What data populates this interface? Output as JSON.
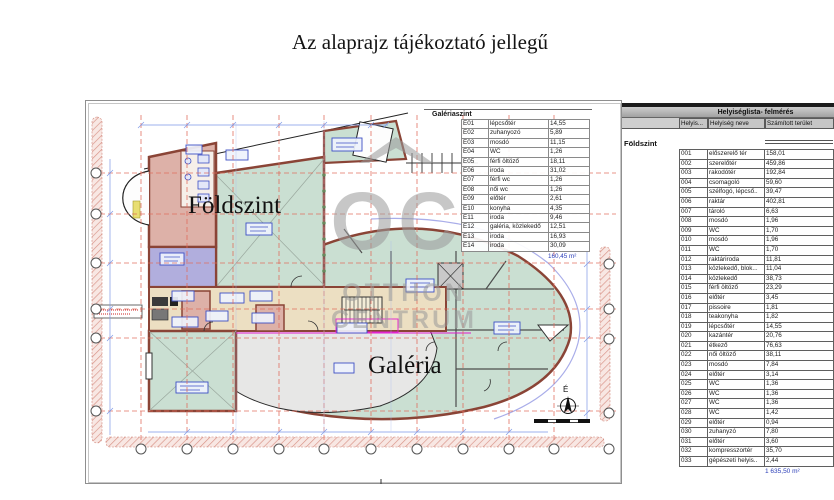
{
  "title": "Az alaprajz tájékoztató jellegű",
  "plan": {
    "floor_label": "Földszint",
    "gallery_label": "Galéria",
    "north_label": "É",
    "watermark": {
      "logo": "OC",
      "line1": "OTTHON",
      "line2": "CENTRUM"
    },
    "galeriaszint_table": {
      "title": "Galériaszint",
      "rows": [
        [
          "E01",
          "lépcsőtér",
          "14,55"
        ],
        [
          "E02",
          "zuhanyozó",
          "5,89"
        ],
        [
          "E03",
          "mosdó",
          "11,15"
        ],
        [
          "E04",
          "WC",
          "1,26"
        ],
        [
          "E05",
          "férfi öltöző",
          "18,11"
        ],
        [
          "E06",
          "iroda",
          "31,02"
        ],
        [
          "E07",
          "férfi wc",
          "1,26"
        ],
        [
          "E08",
          "női wc",
          "1,26"
        ],
        [
          "E09",
          "előtér",
          "2,61"
        ],
        [
          "E10",
          "konyha",
          "4,35"
        ],
        [
          "E11",
          "iroda",
          "9,46"
        ],
        [
          "E12",
          "galéria, közlekedő",
          "12,51"
        ],
        [
          "E13",
          "iroda",
          "16,93"
        ],
        [
          "E14",
          "iroda",
          "30,09"
        ]
      ],
      "total": "160,45 m²"
    }
  },
  "room_list": {
    "title": "Helyiséglista- felmérés",
    "columns": [
      "Helyis...",
      "Helyiség neve",
      "Számított terület"
    ],
    "section": "Földszint",
    "rows": [
      [
        "001",
        "előszerelő tér",
        "158,01"
      ],
      [
        "002",
        "szerelőtér",
        "459,86"
      ],
      [
        "003",
        "rakodótér",
        "192,84"
      ],
      [
        "004",
        "csomagoló",
        "59,60"
      ],
      [
        "005",
        "szélfogó, lépcső..",
        "39,47"
      ],
      [
        "006",
        "raktár",
        "402,81"
      ],
      [
        "007",
        "tároló",
        "6,63"
      ],
      [
        "008",
        "mosdó",
        "1,96"
      ],
      [
        "009",
        "WC",
        "1,70"
      ],
      [
        "010",
        "mosdó",
        "1,96"
      ],
      [
        "011",
        "WC",
        "1,70"
      ],
      [
        "012",
        "raktáriroda",
        "11,81"
      ],
      [
        "013",
        "közlekedő, blok...",
        "11,04"
      ],
      [
        "014",
        "közlekedő",
        "38,73"
      ],
      [
        "015",
        "férfi öltöző",
        "23,29"
      ],
      [
        "016",
        "előtér",
        "3,45"
      ],
      [
        "017",
        "pissoire",
        "1,81"
      ],
      [
        "018",
        "teakonyha",
        "1,82"
      ],
      [
        "019",
        "lépcsőtér",
        "14,55"
      ],
      [
        "020",
        "kazántér",
        "20,76"
      ],
      [
        "021",
        "étkező",
        "76,63"
      ],
      [
        "022",
        "női öltöző",
        "38,11"
      ],
      [
        "023",
        "mosdó",
        "7,84"
      ],
      [
        "024",
        "előtér",
        "3,14"
      ],
      [
        "025",
        "WC",
        "1,36"
      ],
      [
        "026",
        "WC",
        "1,36"
      ],
      [
        "027",
        "WC",
        "1,36"
      ],
      [
        "028",
        "WC",
        "1,42"
      ],
      [
        "029",
        "előtér",
        "0,94"
      ],
      [
        "030",
        "zuhanyzó",
        "7,80"
      ],
      [
        "031",
        "előtér",
        "3,60"
      ],
      [
        "032",
        "kompresszortér",
        "35,70"
      ],
      [
        "033",
        "gépészeti helyis..",
        "2,44"
      ]
    ],
    "total": "1 635,50 m²"
  },
  "colors": {
    "wall": "#8a4436",
    "room_green": "#cadfd2",
    "room_pink": "#ddb1a8",
    "room_purple": "#b1aedd",
    "room_tan": "#ecdfc2",
    "gallery_gray": "#e7e7e6",
    "grid_red": "#e0695a",
    "dimension_blue": "#7e98e6",
    "label_blue": "#3d4fc4",
    "total_blue": "#2a3db8"
  }
}
